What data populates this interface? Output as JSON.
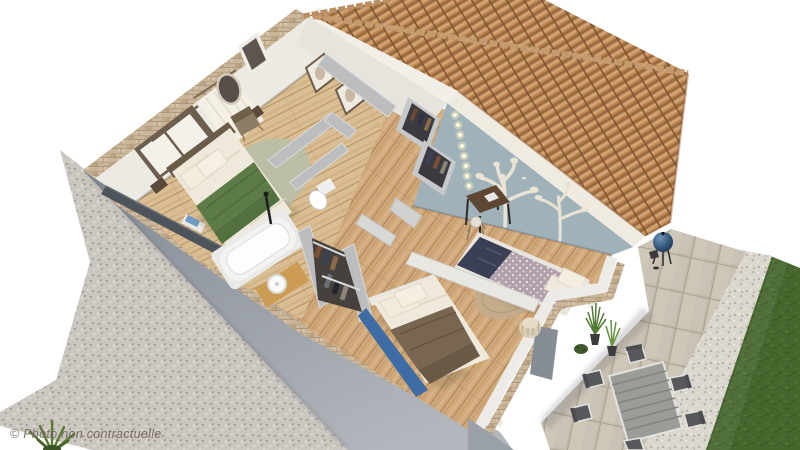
{
  "watermark": "© Photo non contractuelle",
  "palette": {
    "background": "#ffffff",
    "gravel": "#cbc6c0",
    "wall_gray": "#8f96a0",
    "brick": "#c8b59a",
    "wall_white": "#edeae4",
    "partition": "#bcbdbf",
    "floor_wood": "#d0a97b",
    "floor_master": "#d9bd93",
    "roof_tile": "#c28a55",
    "roof_ridge": "#c39b6f",
    "eave_white": "#f0ebe1",
    "blue_wall": "#9fb2ba",
    "tree_decal": "#eae3d4",
    "led_glow": "#fff2b8",
    "green_blanket": "#5d7b47",
    "duvet_white": "#efe9dc",
    "kids_duvet": "#b2a1ac",
    "navy_throw": "#3a3f55",
    "brown_throw": "#786650",
    "sheet_blue": "#3e6da6",
    "rug_master": "#b8bfa9",
    "rug_kids": "#c4ac8b",
    "pouf": "#d9cdb5",
    "vanity_wood": "#cc9c55",
    "patio_stone": "#cac2b3",
    "white_gravel": "#dbd7cf",
    "lawn_green": "#47662e",
    "table_gray": "#9b9b97",
    "chair_dark": "#56585c",
    "chair_frame": "#e2e2df",
    "bbq_blue": "#2f5174",
    "railing_dark": "#4e545c",
    "curtain": "#f4efe5",
    "watermark_text": "#6f6159"
  },
  "scene": {
    "type": "3d-floor-plan-cutaway-render",
    "level": "upper-floor",
    "rooms": [
      {
        "name": "master-bedroom",
        "furniture": [
          "double-bed-green-blanket",
          "round-rug",
          "armchair",
          "curtained-window",
          "wall-mirror",
          "balcony-railing"
        ]
      },
      {
        "name": "bathroom",
        "furniture": [
          "bathtub",
          "wood-vanity-round-sink",
          "black-faucet-stand"
        ]
      },
      {
        "name": "wc",
        "furniture": [
          "toilet"
        ]
      },
      {
        "name": "dressing",
        "furniture": [
          "open-wardrobes-with-clothes"
        ]
      },
      {
        "name": "kids-bedroom",
        "furniture": [
          "bed-dotted-duvet",
          "tree-wall-decals",
          "string-lights",
          "desk",
          "chair",
          "round-jute-rug",
          "wardrobe"
        ]
      },
      {
        "name": "bedroom-3",
        "furniture": [
          "double-bed-white-duvet-brown-throw",
          "fluted-pouf"
        ]
      }
    ],
    "exterior": [
      "terracotta-tile-roof",
      "gravel-ground",
      "stone-patio",
      "kettle-bbq",
      "outdoor-dining-table",
      "six-chairs",
      "potted-grasses",
      "white-gravel-border",
      "lawn"
    ]
  }
}
